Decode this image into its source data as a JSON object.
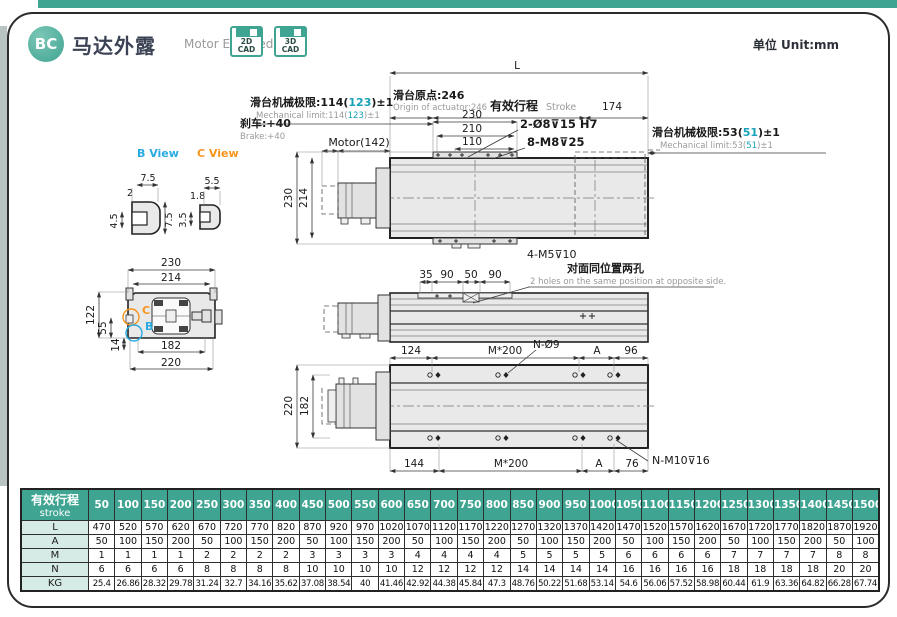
{
  "header": {
    "badge": "BC",
    "title_cn": "马达外露",
    "title_en": "Motor Exposed",
    "cad": [
      {
        "line1": "2D",
        "line2": "CAD"
      },
      {
        "line1": "3D",
        "line2": "CAD"
      }
    ],
    "unit_label": "单位 Unit:mm"
  },
  "colors": {
    "accent_teal": "#3fa491",
    "teal_value": "#17a2b8",
    "b_view_blue": "#29abe2",
    "c_view_orange": "#f7941d",
    "table_label_bg": "#d6ebe5"
  },
  "views": {
    "top": {
      "L": "L",
      "origin_cn": "滑台原点:246",
      "origin_en": "Origin of actuator:246",
      "stroke_cn": "有效行程",
      "stroke_en": "Stroke",
      "d174": "174",
      "d230": "230",
      "d210": "210",
      "d110": "110",
      "holes_a": "2-Ø8⊽15 H7",
      "holes_b": "8-M8⊽25",
      "motor": "Motor(142)",
      "brake_cn": "刹车:+40",
      "brake_en": "Brake:+40",
      "mlimL_cn_pre": "滑台机械极限:114(",
      "mlimL_val": "123",
      "mlimL_suf": ")±1",
      "mlimL_en_pre": "Mechanical limit:114(",
      "mlimL_en_val": "123",
      "mlimL_en_suf": ")±1",
      "mlimR_cn_pre": "滑台机械极限:53(",
      "mlimR_val": "51",
      "mlimR_suf": ")±1",
      "mlimR_en_pre": "Mechanical limit:53(",
      "mlimR_en_val": "51",
      "mlimR_en_suf": ")±1",
      "v230": "230",
      "v214": "214",
      "m5": "4-M5⊽10"
    },
    "middle": {
      "d35": "35",
      "d90a": "90",
      "d50": "50",
      "d90b": "90",
      "note_cn": "对面同位置两孔",
      "note_en": "2 holes on the same position at opposite side."
    },
    "bottom": {
      "d124": "124",
      "m200a": "M*200",
      "n_o9": "N-Ø9",
      "dA1": "A",
      "d96": "96",
      "v220": "220",
      "v182": "182",
      "d144": "144",
      "m200b": "M*200",
      "dA2": "A",
      "d76": "76",
      "nm10": "N-M10⊽16"
    },
    "section": {
      "d230": "230",
      "d214": "214",
      "d122": "122",
      "d55": "55",
      "d14": "14",
      "d182": "182",
      "d220": "220",
      "c_mark": "C",
      "b_mark": "B"
    },
    "b_view": {
      "label": "B View",
      "d_top": "7.5",
      "d_small": "2",
      "d_right": "7.5",
      "d_left": "4.5"
    },
    "c_view": {
      "label": "C View",
      "d_top": "5.5",
      "d_small": "1.8",
      "d_left": "3.5"
    }
  },
  "table": {
    "header_cn": "有效行程",
    "header_en": "stroke",
    "strokes": [
      "50",
      "100",
      "150",
      "200",
      "250",
      "300",
      "350",
      "400",
      "450",
      "500",
      "550",
      "600",
      "650",
      "700",
      "750",
      "800",
      "850",
      "900",
      "950",
      "1000",
      "1050",
      "1100",
      "1150",
      "1200",
      "1250",
      "1300",
      "1350",
      "1400",
      "1450",
      "1500"
    ],
    "rows": [
      {
        "label": "L",
        "values": [
          "470",
          "520",
          "570",
          "620",
          "670",
          "720",
          "770",
          "820",
          "870",
          "920",
          "970",
          "1020",
          "1070",
          "1120",
          "1170",
          "1220",
          "1270",
          "1320",
          "1370",
          "1420",
          "1470",
          "1520",
          "1570",
          "1620",
          "1670",
          "1720",
          "1770",
          "1820",
          "1870",
          "1920"
        ]
      },
      {
        "label": "A",
        "values": [
          "50",
          "100",
          "150",
          "200",
          "50",
          "100",
          "150",
          "200",
          "50",
          "100",
          "150",
          "200",
          "50",
          "100",
          "150",
          "200",
          "50",
          "100",
          "150",
          "200",
          "50",
          "100",
          "150",
          "200",
          "50",
          "100",
          "150",
          "200",
          "50",
          "100"
        ]
      },
      {
        "label": "M",
        "values": [
          "1",
          "1",
          "1",
          "1",
          "2",
          "2",
          "2",
          "2",
          "3",
          "3",
          "3",
          "3",
          "4",
          "4",
          "4",
          "4",
          "5",
          "5",
          "5",
          "5",
          "6",
          "6",
          "6",
          "6",
          "7",
          "7",
          "7",
          "7",
          "8",
          "8"
        ]
      },
      {
        "label": "N",
        "values": [
          "6",
          "6",
          "6",
          "6",
          "8",
          "8",
          "8",
          "8",
          "10",
          "10",
          "10",
          "10",
          "12",
          "12",
          "12",
          "12",
          "14",
          "14",
          "14",
          "14",
          "16",
          "16",
          "16",
          "16",
          "18",
          "18",
          "18",
          "18",
          "20",
          "20"
        ]
      },
      {
        "label": "KG",
        "values": [
          "25.4",
          "26.86",
          "28.32",
          "29.78",
          "31.24",
          "32.7",
          "34.16",
          "35.62",
          "37.08",
          "38.54",
          "40",
          "41.46",
          "42.92",
          "44.38",
          "45.84",
          "47.3",
          "48.76",
          "50.22",
          "51.68",
          "53.14",
          "54.6",
          "56.06",
          "57.52",
          "58.98",
          "60.44",
          "61.9",
          "63.36",
          "64.82",
          "66.28",
          "67.74"
        ]
      }
    ]
  }
}
